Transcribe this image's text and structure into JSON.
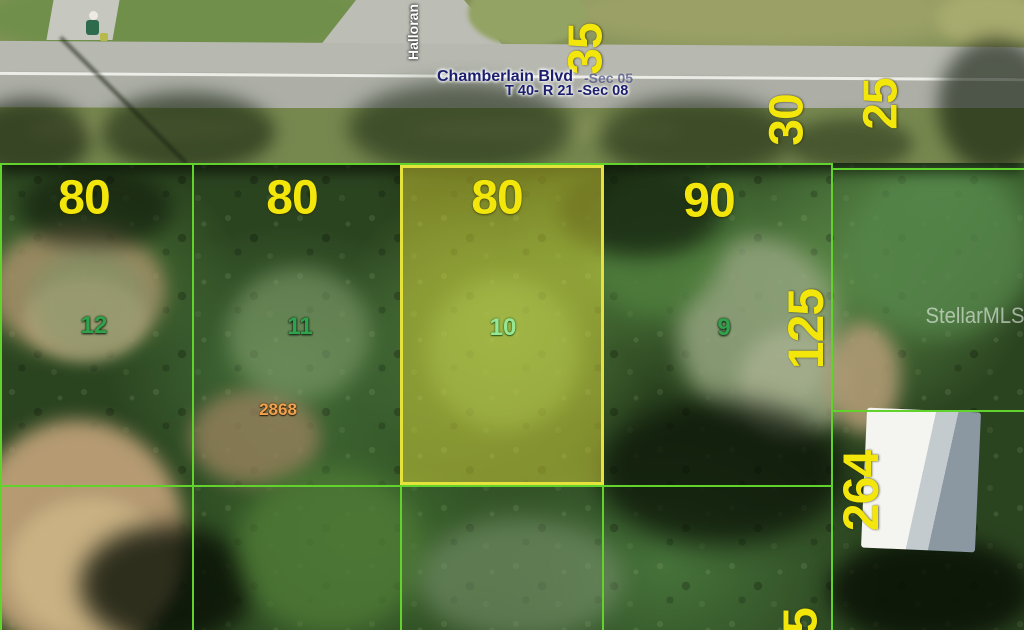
{
  "road": {
    "name": "Chamberlain Blvd",
    "section": "-Sec 05",
    "township_range": "T 40- R 21 -Sec 08",
    "cross_street": "Halloran"
  },
  "parcel_dimensions": {
    "lot12_frontage": "80",
    "lot11_frontage": "80",
    "lot10_frontage": "80",
    "lot9_frontage": "90",
    "right_of_way_35": "35",
    "right_of_way_30": "30",
    "right_of_way_25": "25",
    "depth_125": "125",
    "depth_264": "264",
    "depth_partial_5": "5"
  },
  "lot_numbers": {
    "lot12": "12",
    "lot11": "11",
    "lot10": "10",
    "lot9": "9"
  },
  "parcel_id": "2868",
  "watermark": "StellarMLS",
  "colors": {
    "dimension_text": "#f3e60b",
    "boundary_line": "#62d32c",
    "highlight_border": "#e6e23c",
    "highlight_fill": "rgba(230,225,60,0.45)",
    "lot_number_text": "#2fa24b",
    "highlighted_lot_number_text": "#96e794",
    "parcel_id_text": "#f2a24e",
    "road_label_text": "#1c1f6e"
  }
}
